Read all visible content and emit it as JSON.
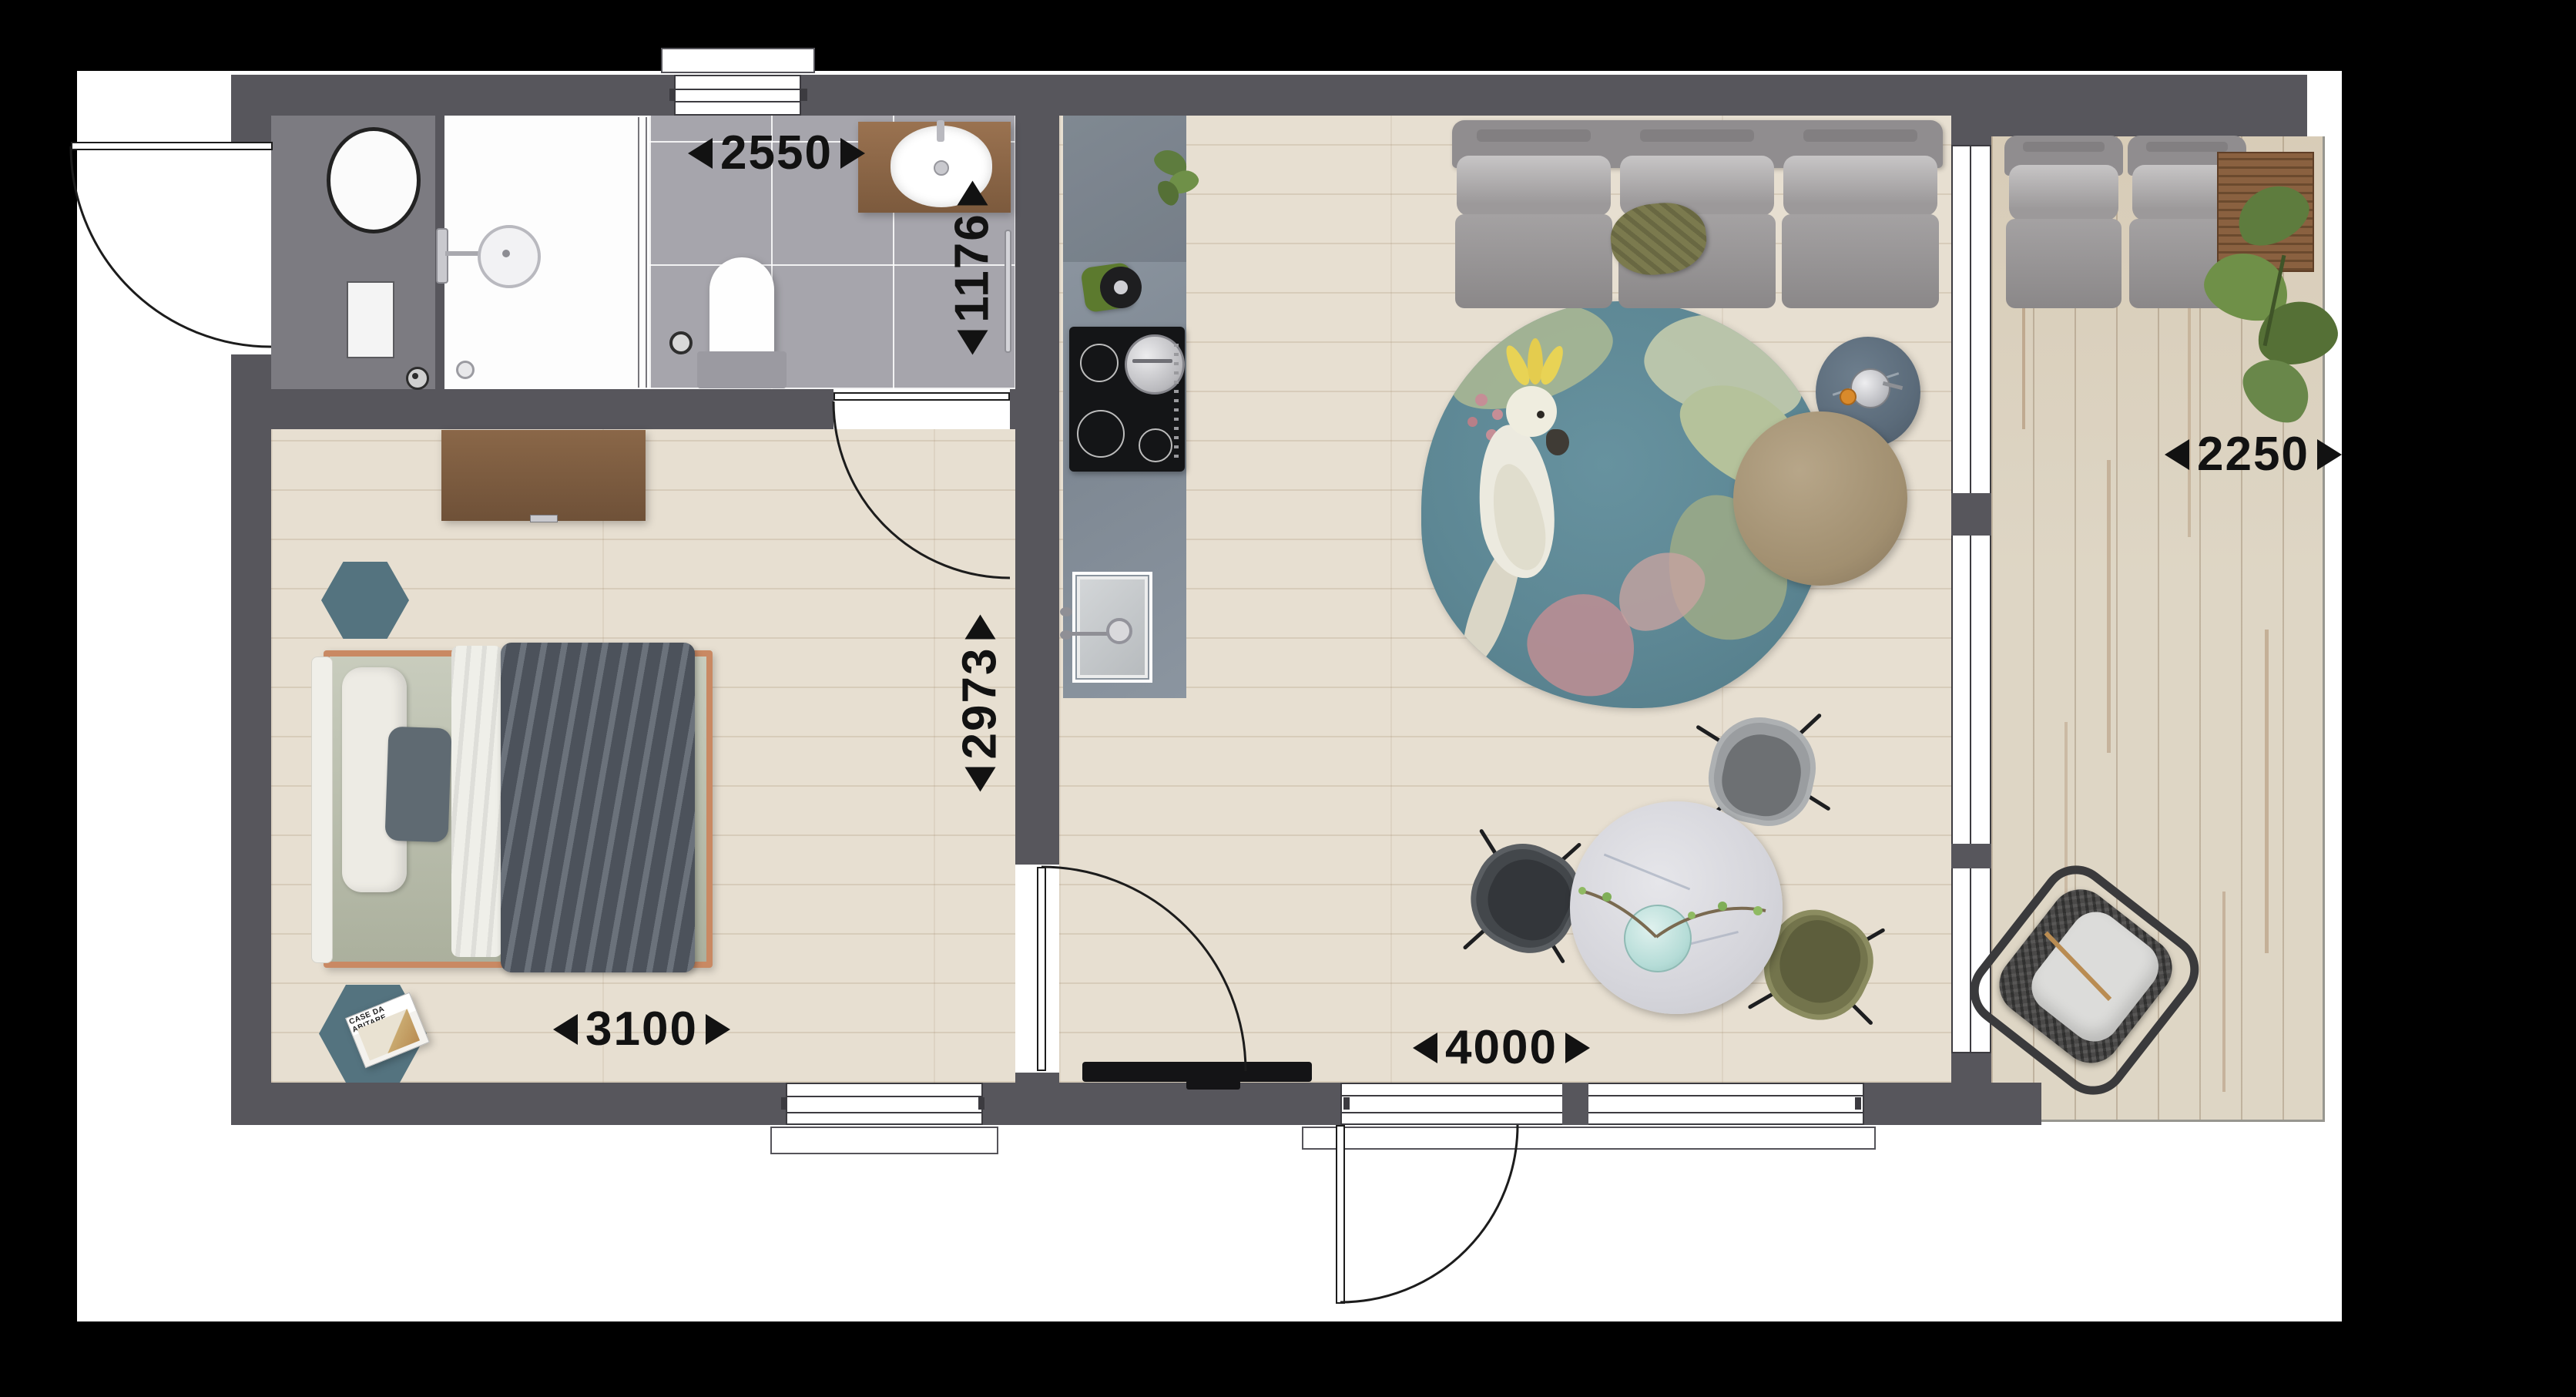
{
  "dimensions": {
    "bathroom_width_mm": "2550",
    "bathroom_depth_mm": "1176",
    "bedroom_depth_mm": "2973",
    "bedroom_width_mm": "3100",
    "living_width_mm": "4000",
    "terrace_width_mm": "2250"
  },
  "magazine": {
    "title": "CASE DA ABITARE"
  },
  "colors": {
    "wall": "#57565c",
    "page": "#ffffff",
    "parquet": "#e7dfd1",
    "bath_tile": "#a6a5ac",
    "utility_floor": "#7c7b81",
    "kitchen_counter": "#8b95a0",
    "terrace_deck": "#ded6c5",
    "rug_teal": "#5d8794",
    "hex_rug_teal": "#54737f",
    "bed_frame_copper": "#c98963",
    "bed_mattress_sage": "#b6bba7",
    "blanket_gray": "#5a626c",
    "sofa_gray": "#9a9798",
    "olive_pillow": "#7b7a4e",
    "pouf_taupe": "#a89276",
    "dining_table_marble": "#d9dade",
    "chair_gray": "#85888b",
    "chair_black": "#43474b",
    "chair_olive": "#73744c",
    "wood_brown": "#8a6140",
    "dresser_brown": "#85624a",
    "side_table_slate": "#5b6b7a",
    "plant_green": "#5e7c3e",
    "cockatoo_crest_yellow": "#e8d355"
  }
}
